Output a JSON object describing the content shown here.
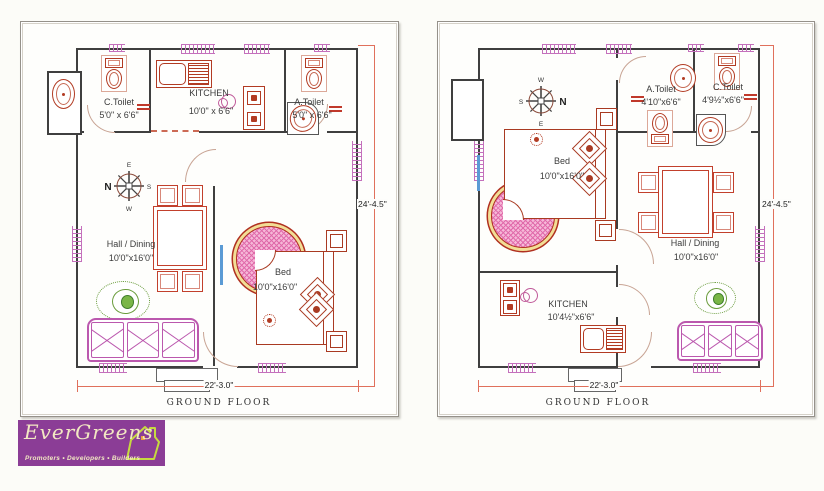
{
  "left_plan": {
    "rooms": {
      "c_toilet": {
        "name": "C.Toilet",
        "size": "5'0\" x 6'6\""
      },
      "kitchen": {
        "name": "KITCHEN",
        "size": "10'0\" x 6'6\""
      },
      "a_toilet": {
        "name": "A.Toilet",
        "size": "5'0\" x 6'6\""
      },
      "hall": {
        "name": "Hall / Dining",
        "size": "10'0\"x16'0\""
      },
      "bed": {
        "name": "Bed",
        "size": "10'0\"x16'0\""
      }
    },
    "compass": {
      "top": "E",
      "right": "S",
      "bottom": "W",
      "left": "N"
    },
    "dimensions": {
      "height": "24'-4.5\"",
      "width": "22'-3.0\""
    },
    "caption": "GROUND FLOOR"
  },
  "right_plan": {
    "rooms": {
      "a_toilet": {
        "name": "A.Toilet",
        "size": "4'10\"x6'6\""
      },
      "c_toilet": {
        "name": "C.Toilet",
        "size": "4'9½\"x6'6\""
      },
      "bed": {
        "name": "Bed",
        "size": "10'0\"x16'0\""
      },
      "hall": {
        "name": "Hall / Dining",
        "size": "10'0\"x16'0\""
      },
      "kitchen": {
        "name": "KITCHEN",
        "size": "10'4½\"x6'6\""
      }
    },
    "compass": {
      "top": "W",
      "right": "N",
      "bottom": "E",
      "left": "S"
    },
    "dimensions": {
      "height": "24'-4.5\"",
      "width": "22'-3.0\""
    },
    "caption": "GROUND FLOOR"
  },
  "logo": {
    "brand": "EverGreens",
    "tagline": "Promoters • Developers • Builders"
  },
  "colors": {
    "wall": "#3f3f3f",
    "fixture_red": "#b23b23",
    "dimension_red": "#e0705c",
    "window_pink": "#c470bc",
    "sofa_pink": "#bb58ae",
    "rug_pink": "#f6b8d8",
    "rug_ring_yellow": "#f2de96",
    "rug_green": "#6a9c3c",
    "logo_purple": "#8b3d96",
    "logo_cream": "#f2e8c2",
    "logo_house_green": "#c6da3f"
  }
}
